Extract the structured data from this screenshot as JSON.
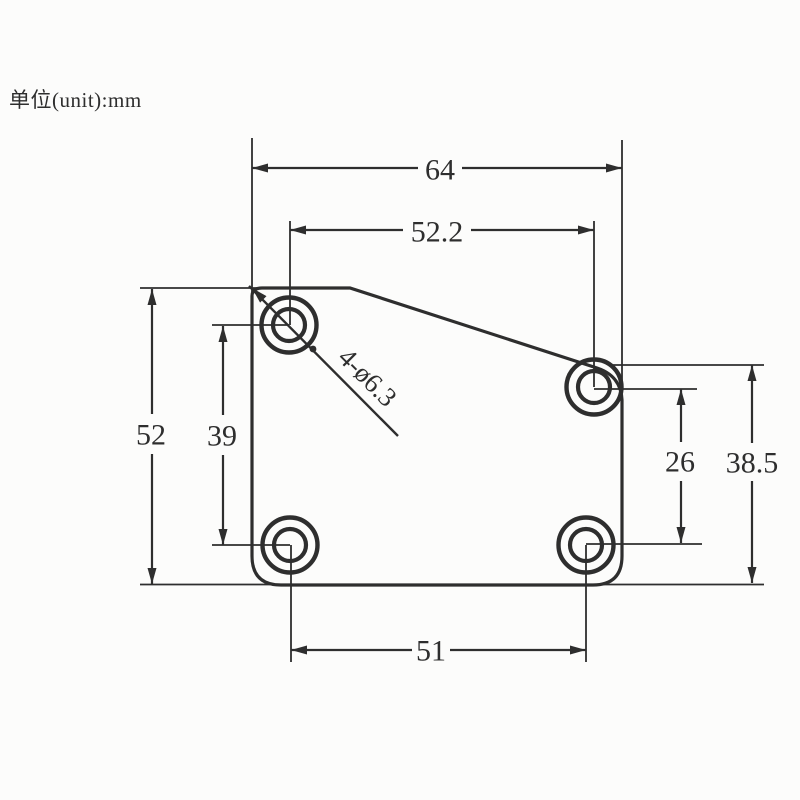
{
  "page": {
    "background": "#fcfcfb",
    "ink": "#2e2e2e",
    "units_label": "单位(unit):mm"
  },
  "drawing": {
    "dimensions": {
      "overall_width": "64",
      "top_hole_span": "52.2",
      "overall_height": "52",
      "left_hole_span": "39",
      "right_hole_span": "26",
      "right_height": "38.5",
      "bottom_hole_span": "51",
      "hole_callout": "4-ø6.3"
    }
  }
}
